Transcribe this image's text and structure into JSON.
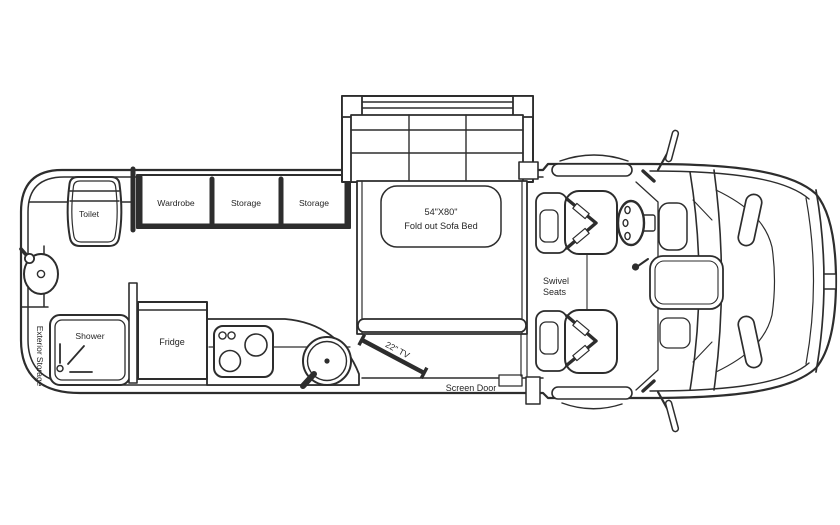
{
  "diagram": {
    "kind": "rv-floorplan-top-view",
    "background": "#ffffff",
    "line_color": "#2d2d2d",
    "text_color": "#262626"
  },
  "labels": {
    "toilet": "Toilet",
    "wardrobe": "Wardrobe",
    "storage_1": "Storage",
    "storage_2": "Storage",
    "sofa_bed_size": "54\"X80\"",
    "sofa_bed_name": "Fold out Sofa Bed",
    "swivel_line1": "Swivel",
    "swivel_line2": "Seats",
    "shower": "Shower",
    "fridge": "Fridge",
    "tv": "22\" TV",
    "screen_door": "Screen Door",
    "exterior_storage": "Exterior Storage"
  }
}
